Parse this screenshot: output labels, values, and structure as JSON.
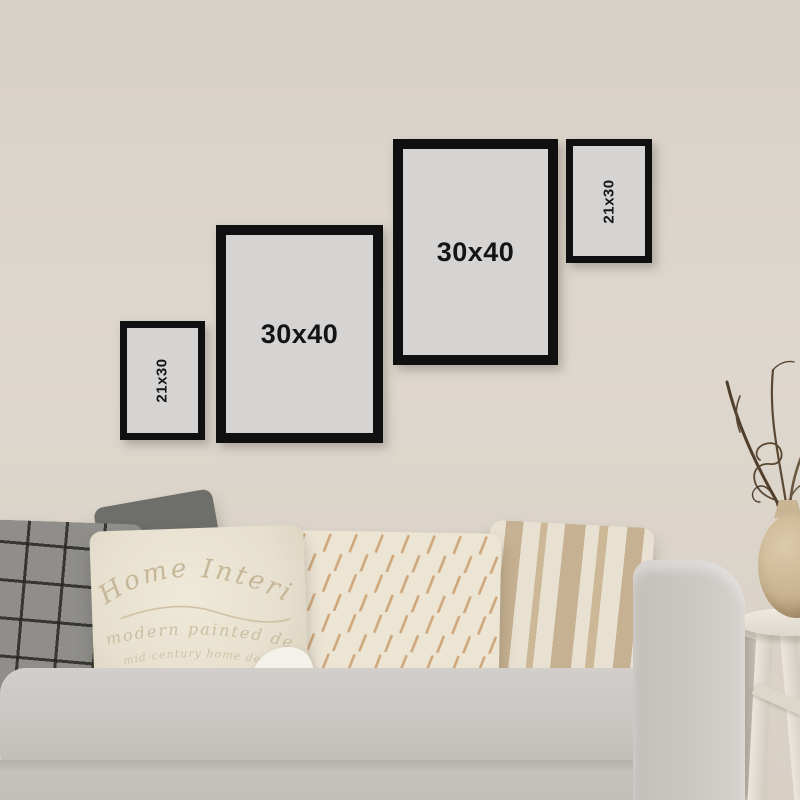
{
  "scene": {
    "description": "Living-room product mock-up: four black photo frames on a beige wall above a grey sofa with four cushions, dried branches in a vase on a white stool",
    "wall_color": "#d9d2c8",
    "frame_border_color": "#101010",
    "frame_mat_color": "#d6d4d3",
    "sofa_color": "#c8c4c0",
    "plaid_pillow_color": "#8f8e8b",
    "cream_pillow_color": "#ece5d4",
    "stripe_color": "#c6b192",
    "stool_color": "#ece7df",
    "vase_color": "#cab390",
    "branch_color": "#54432f"
  },
  "frames": [
    {
      "label": "21x30",
      "size": "small",
      "label_orientation": "vertical"
    },
    {
      "label": "30x40",
      "size": "large",
      "label_orientation": "horizontal"
    },
    {
      "label": "30x40",
      "size": "large",
      "label_orientation": "horizontal"
    },
    {
      "label": "21x30",
      "size": "small",
      "label_orientation": "vertical"
    }
  ],
  "pillows": {
    "text_pillow": {
      "line1": "Home Interior",
      "line2": "modern painted decor",
      "line3": "mid-century home design"
    }
  }
}
